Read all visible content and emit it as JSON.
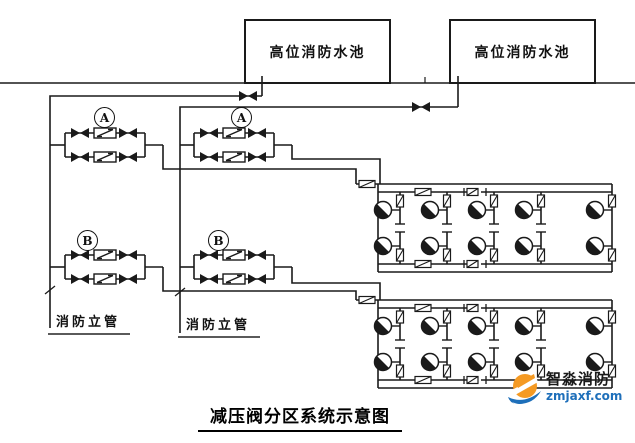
{
  "title": {
    "text": "减压阀分区系统示意图"
  },
  "tanks": [
    {
      "label": "高位消防水池"
    },
    {
      "label": "高位消防水池"
    }
  ],
  "valve_groups": [
    {
      "label": "A"
    },
    {
      "label": "A"
    },
    {
      "label": "B"
    },
    {
      "label": "B"
    }
  ],
  "standpipes": [
    {
      "label": "消防立管"
    },
    {
      "label": "消防立管"
    }
  ],
  "watermark": {
    "name": "智淼消防",
    "url": "zmjaxf.com"
  },
  "colors": {
    "line": "#1a1a1a",
    "underline": "#5a5a5a",
    "title": "#000000",
    "watermark_orange": "#f59a23",
    "watermark_blue": "#1e6fba",
    "url_blue": "#1e6fba"
  }
}
